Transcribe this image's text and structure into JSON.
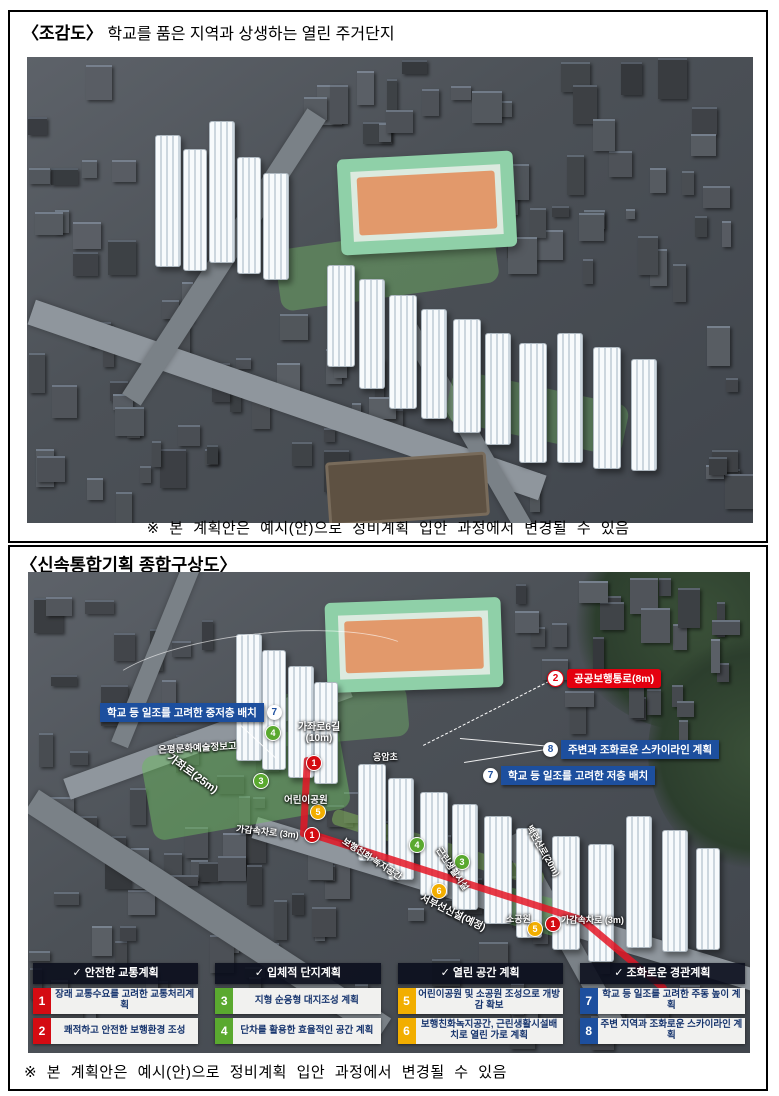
{
  "box1": {
    "tag": "〈조감도〉",
    "title": "학교를 품은 지역과 상생하는 열린 주거단지",
    "caption": "※ 본 계획안은 예시(안)으로 정비계획 입안 과정에서 변경될 수 있음"
  },
  "box2": {
    "title": "〈신속통합기획 종합구상도〉",
    "caption": "※ 본 계획안은 예시(안)으로 정비계획 입안 과정에서 변경될 수 있음"
  },
  "map": {
    "callouts": {
      "mid_low": {
        "num": "7",
        "text": "학교 등 일조를 고려한 중저층 배치"
      },
      "public_walk": {
        "num": "2",
        "text": "공공보행통로(8m)"
      },
      "skyline": {
        "num": "8",
        "text": "주변과 조화로운 스카이라인 계획"
      },
      "low_rise": {
        "num": "7",
        "text": "학교 등 일조를 고려한 저층 배치"
      }
    },
    "roads": {
      "gajwa": "가좌로(25m)",
      "gajwa6_line1": "가좌로6길",
      "gajwa6_line2": "(10m)",
      "accel_left": "가감속차로 (3m)",
      "accel_right": "가감속차로 (3m)",
      "seobu_line": "서부선신설(예정)",
      "baekryeon": "백련산로(20m)",
      "green_walk": "보행친화 녹지공간",
      "neighborhood": "근린생활시설"
    },
    "places": {
      "school_info": "은평문화예술정보고",
      "school_elem": "응암초",
      "children_park": "어린이공원",
      "small_park": "소공원"
    },
    "markers": [
      {
        "n": "1"
      },
      {
        "n": "4"
      },
      {
        "n": "3"
      },
      {
        "n": "5"
      },
      {
        "n": "1"
      },
      {
        "n": "4"
      },
      {
        "n": "3"
      },
      {
        "n": "6"
      },
      {
        "n": "5"
      },
      {
        "n": "1"
      }
    ]
  },
  "legend": {
    "columns": [
      {
        "header": "✓ 안전한 교통계획",
        "items": [
          {
            "num": "1",
            "text": "장래 교통수요를 고려한 교통처리계획"
          },
          {
            "num": "2",
            "text": "쾌적하고 안전한 보행환경 조성"
          }
        ]
      },
      {
        "header": "✓ 입체적 단지계획",
        "items": [
          {
            "num": "3",
            "text": "지형 순응형 대지조성 계획"
          },
          {
            "num": "4",
            "text": "단차를 활용한 효율적인 공간 계획"
          }
        ]
      },
      {
        "header": "✓ 열린 공간 계획",
        "items": [
          {
            "num": "5",
            "text": "어린이공원 및 소공원 조성으로 개방감 확보"
          },
          {
            "num": "6",
            "text": "보행친화녹지공간, 근린생활시설배치로 열린 가로 계획"
          }
        ]
      },
      {
        "header": "✓ 조화로운 경관계획",
        "items": [
          {
            "num": "7",
            "text": "학교 등 일조를 고려한 주동 높이 계획"
          },
          {
            "num": "8",
            "text": "주변 지역과 조화로운 스카이라인 계획"
          }
        ]
      }
    ],
    "colors": {
      "traffic": "#d40b12",
      "site": "#5aa92f",
      "open": "#f2ae00",
      "landscape": "#1d4f9e"
    }
  }
}
